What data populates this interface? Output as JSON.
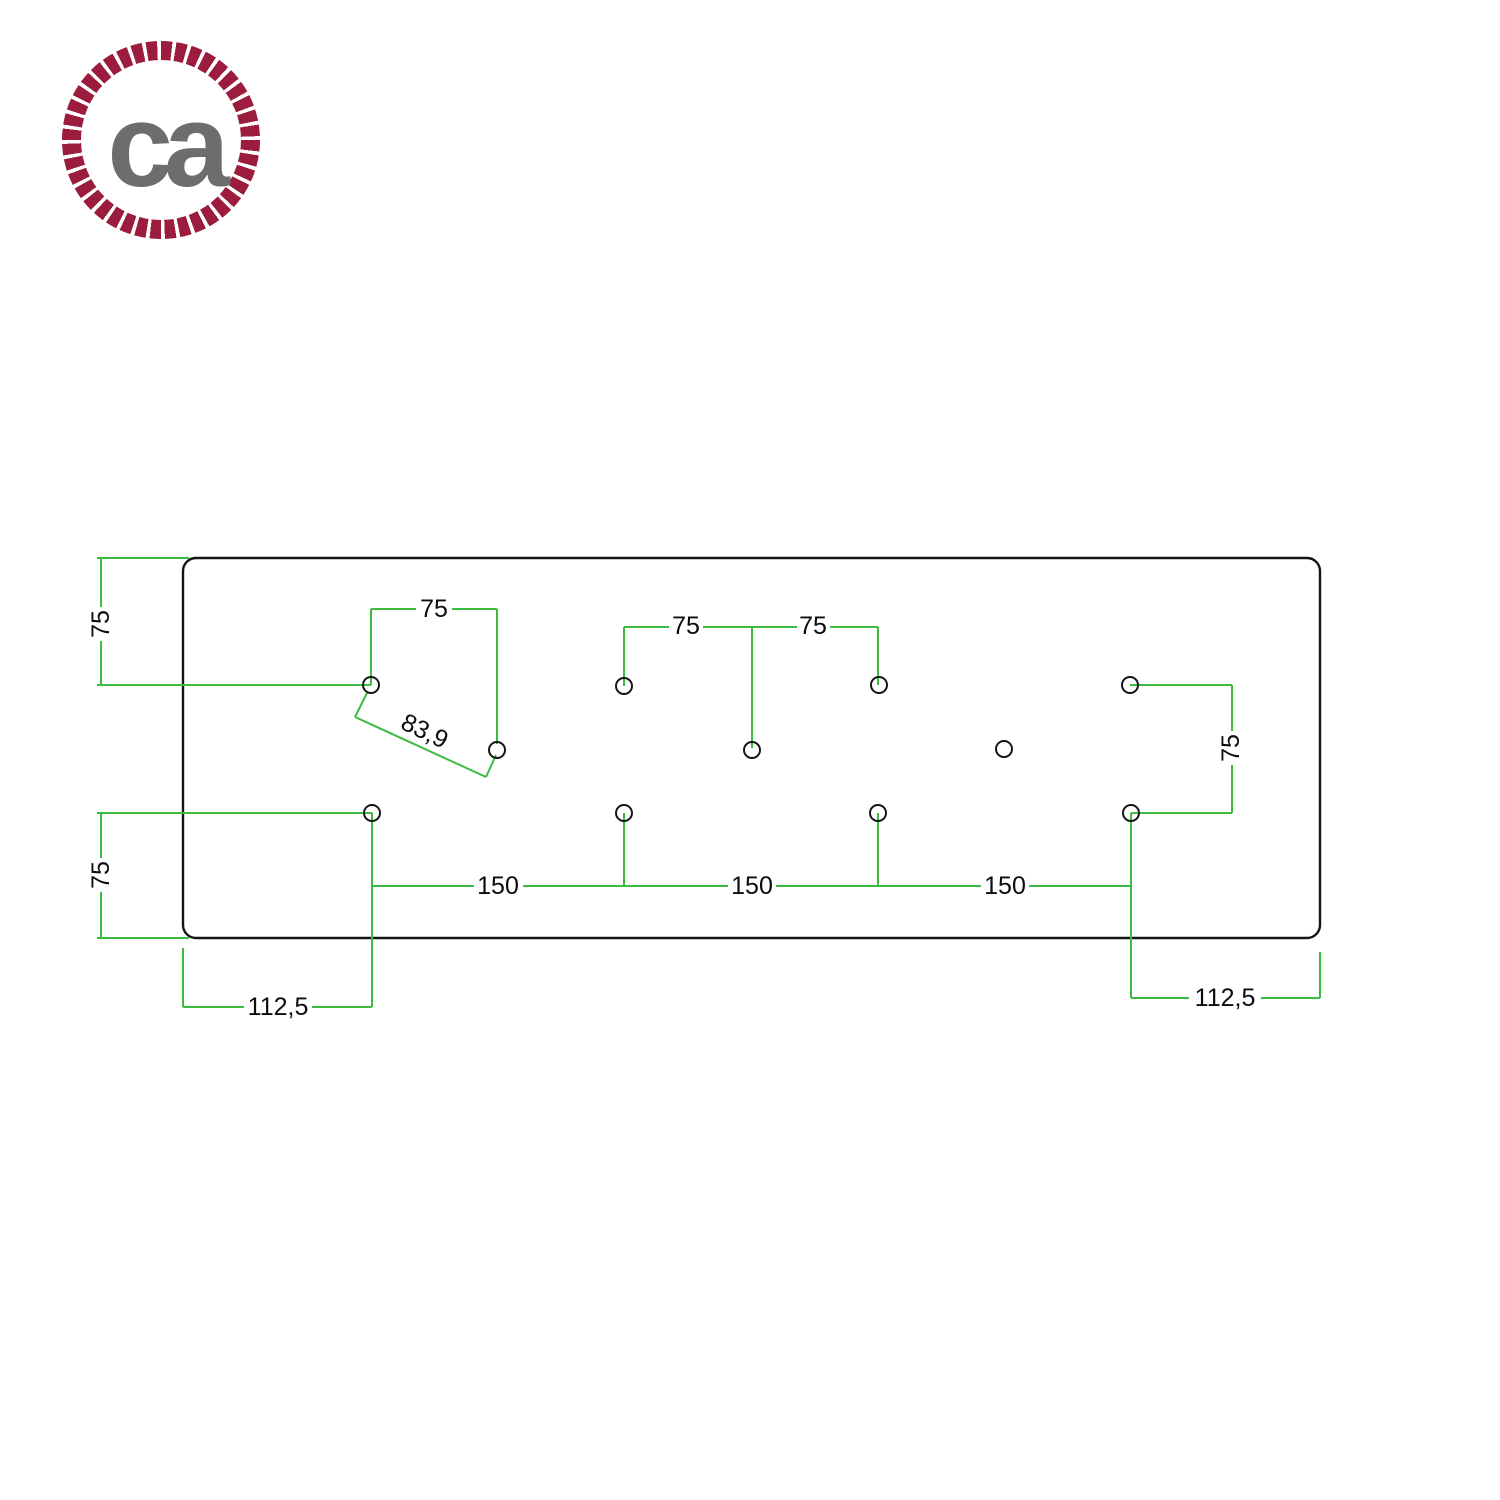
{
  "logo": {
    "text": "ca",
    "ring_color": "#9b1c3c",
    "text_color": "#6d6d6d"
  },
  "drawing": {
    "dimension_color": "#3cbb41",
    "outline_color": "#151515",
    "hole_count": 11,
    "labels": {
      "left_top_vertical": "75",
      "top_left_span": "75",
      "center_span_left": "75",
      "center_span_right": "75",
      "diagonal": "83,9",
      "right_vertical": "75",
      "left_bottom_vertical": "75",
      "bottom_span_1": "150",
      "bottom_span_2": "150",
      "bottom_span_3": "150",
      "bottom_left_offset": "112,5",
      "bottom_right_offset": "112,5"
    }
  }
}
